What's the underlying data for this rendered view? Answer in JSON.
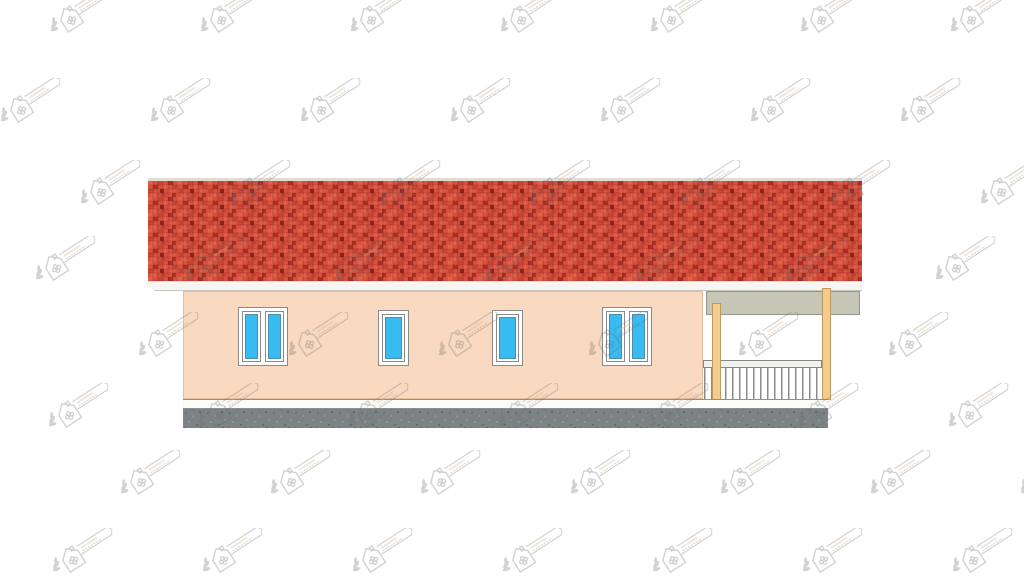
{
  "scene": {
    "type": "architectural-elevation-drawing",
    "description": "Side elevation of a single-storey house: red brick-tiled roof, peach render walls, four blue uPVC windows, open porch with two timber posts and a white railing, grey concrete foundation strip, tiled logo watermarks over white background"
  },
  "colors": {
    "background": "#ffffff",
    "ridge": "#e0ddd6",
    "roof_base": "#d85140",
    "roof_brick_light": "#e2614b",
    "roof_brick_mid": "#c64534",
    "roof_brick_dark": "#a93023",
    "roof_brick_deep": "#8c261c",
    "fascia": "#f7f6f2",
    "wall": "#f9d9bf",
    "window_glass": "#38bbf0",
    "window_frame": "#ffffff",
    "window_outline": "#8a8a8a",
    "beam": "#c6c6b6",
    "beam_outline": "#95958a",
    "post": "#f4ca8f",
    "post_outline": "#bf9a5d",
    "rail": "#f2f2ef",
    "rail_outline": "#85858a",
    "baluster": "#8b8b8b",
    "plinth": "#fbfbf8",
    "plinth_outline": "#8f8f8f",
    "foundation": "#7b8384",
    "watermark": "#6e6e6e",
    "watermark_accent": "#d8b184"
  },
  "building": {
    "roof": {
      "name": "red-tiled-roof"
    },
    "wall": {
      "name": "peach-rendered-wall"
    },
    "windows": [
      {
        "name": "double-window-left",
        "x": 238,
        "y": 307,
        "w": 50,
        "h": 59,
        "panes": 2
      },
      {
        "name": "single-window-1",
        "x": 378,
        "y": 310,
        "w": 31,
        "h": 56,
        "panes": 1
      },
      {
        "name": "single-window-2",
        "x": 492,
        "y": 310,
        "w": 31,
        "h": 56,
        "panes": 1
      },
      {
        "name": "double-window-right",
        "x": 602,
        "y": 307,
        "w": 50,
        "h": 59,
        "panes": 2
      }
    ],
    "porch": {
      "posts": 2,
      "railing_balusters": 17
    }
  },
  "watermark": {
    "icon": "house-leaf-logo-watermark",
    "grid": {
      "cols": 8,
      "dx": 150,
      "box_w": 80,
      "box_h": 52,
      "rows": [
        {
          "y": -12,
          "x0": 40
        },
        {
          "y": 78,
          "x0": -10
        },
        {
          "y": 160,
          "x0": 70
        },
        {
          "y": 236,
          "x0": 25
        },
        {
          "y": 312,
          "x0": 128
        },
        {
          "y": 383,
          "x0": 38
        },
        {
          "y": 450,
          "x0": 110
        },
        {
          "y": 528,
          "x0": 42
        }
      ]
    }
  }
}
